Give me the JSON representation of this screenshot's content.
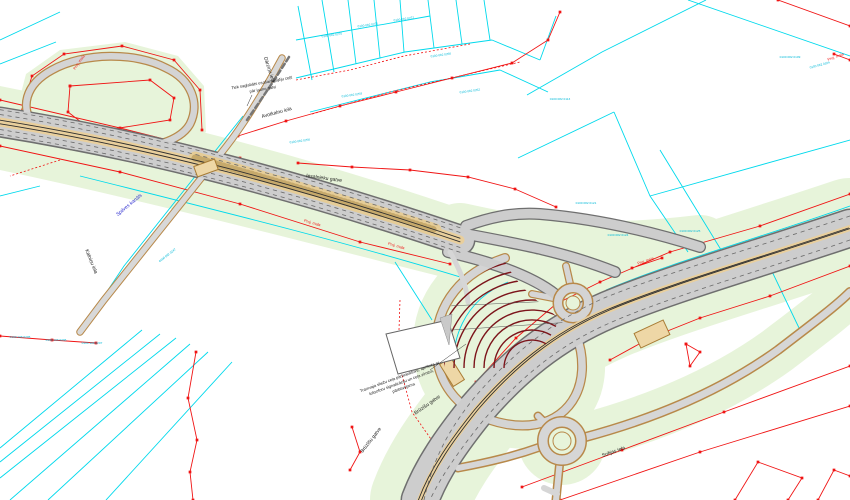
{
  "colors": {
    "cadastral_cyan": "#00d9ec",
    "boundary_red": "#f01414",
    "greenery": "#e7f4da",
    "road_gray": "#cdcdcd",
    "road_casing": "#6f6f6f",
    "paving_tan": "#e9cf9c",
    "ramp_casing_tan": "#b8894a",
    "embankment_dark_red": "#7c151b",
    "water_blue": "#2f2fd0",
    "tram_dark": "#303030"
  },
  "annotations": {
    "preserved_note_line1": "Tiek saglabāts esošais gājēju ceļš",
    "preserved_note_line2": "pār jauno gatvi",
    "tram_note_line1": "Tramvaja sliežu ceļa pārbrauktuve, aprīkota ar",
    "tram_note_line2": "luksoforu signalizāciju un ceļa zīmēm,",
    "tram_note_line3": "pārbūvējama",
    "proj_edge": "Proj. mala"
  },
  "streets": {
    "avotkalnu": "Avotkalnu iela",
    "darzinu": "Dārziņu iela",
    "iesalnieku": "Iesalnieku gatve",
    "kalninu": "Kalniņu iela",
    "bruzisu": "Brūzīšu gatve",
    "sofijas": "Sofijas iela",
    "canal": "Spilves kanāls"
  },
  "parcel_numbers": [
    "0100 082 0270",
    "0100 082 0271",
    "0100 082 0272",
    "0100 082 0266",
    "0100 082 0259",
    "0100 082 0262",
    "0100 082 0113",
    "0100 082 0121",
    "0100 082 0124",
    "0100 082 0125",
    "0100 082 0109",
    "0100 082 0104",
    "0100 082 0256",
    "0100 082 0247",
    "0100 106 0205",
    "0100 106 0206",
    "0100 106 0207"
  ]
}
